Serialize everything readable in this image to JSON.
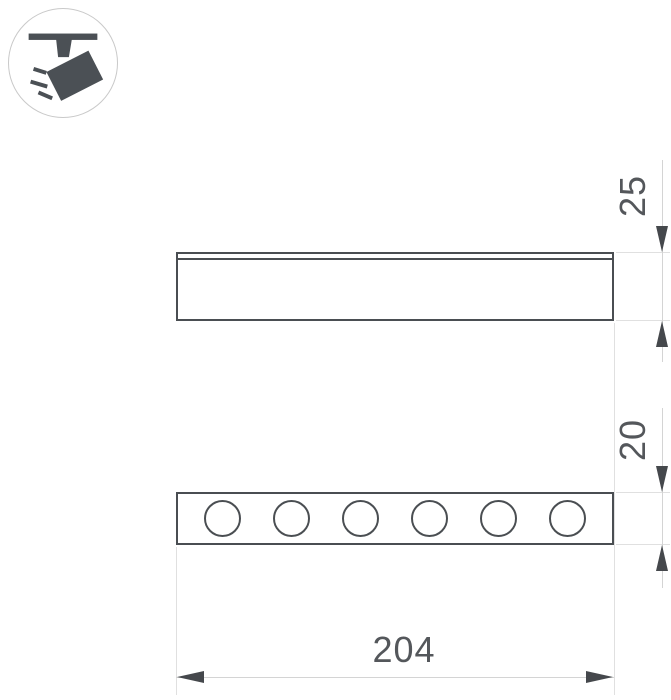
{
  "style": {
    "background": "#ffffff",
    "line_color": "#4a4e52",
    "light_line_color": "#e0e0e0",
    "dim_line_color": "#d4d4d4",
    "arrow_color": "#45484c",
    "text_color": "#54575b",
    "icon_color": "#4b5055",
    "badge_border_color": "#c9c9c9"
  },
  "badge": {
    "icon": "track-spotlight-icon"
  },
  "views": {
    "side": {
      "name": "side-view"
    },
    "bottom": {
      "name": "bottom-view",
      "led_count": 6
    }
  },
  "dimensions": {
    "height": {
      "value": "25"
    },
    "module_height": {
      "value": "20"
    },
    "length": {
      "value": "204"
    }
  }
}
